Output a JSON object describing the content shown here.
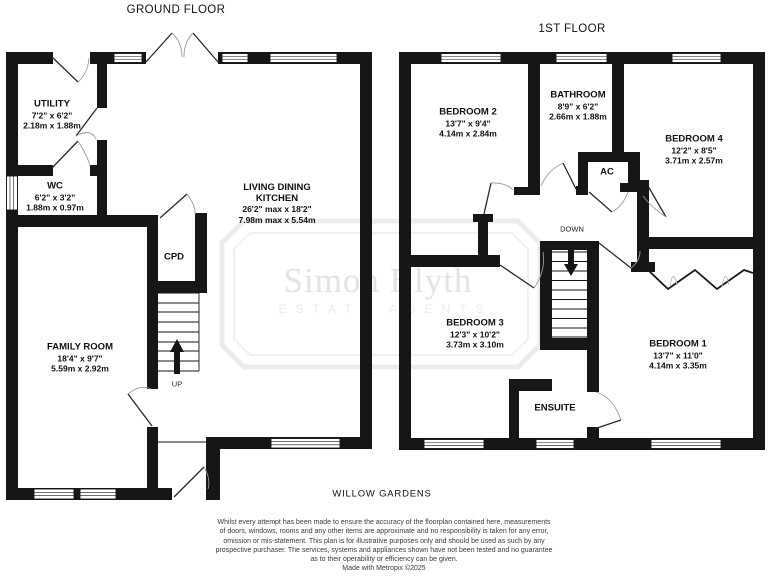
{
  "ground_floor": {
    "title": "GROUND FLOOR",
    "rooms": [
      {
        "name": "UTILITY",
        "imperial": "7'2\" x 6'2\"",
        "metric": "2.18m x 1.88m"
      },
      {
        "name": "WC",
        "imperial": "6'2\" x 3'2\"",
        "metric": "1.88m x 0.97m"
      },
      {
        "name": "LIVING DINING KITCHEN",
        "name_line1": "LIVING DINING",
        "name_line2": "KITCHEN",
        "imperial": "26'2\" max x 18'2\"",
        "metric": "7.98m max x 5.54m"
      },
      {
        "name": "FAMILY ROOM",
        "imperial": "18'4\" x 9'7\"",
        "metric": "5.59m x 2.92m"
      }
    ],
    "cupboard_label": "CPD",
    "stairs_label": "UP"
  },
  "first_floor": {
    "title": "1ST FLOOR",
    "rooms": [
      {
        "name": "BEDROOM 2",
        "imperial": "13'7\" x 9'4\"",
        "metric": "4.14m x 2.84m"
      },
      {
        "name": "BATHROOM",
        "imperial": "8'9\" x 6'2\"",
        "metric": "2.66m x 1.88m"
      },
      {
        "name": "BEDROOM 4",
        "imperial": "12'2\" x 8'5\"",
        "metric": "3.71m x 2.57m"
      },
      {
        "name": "BEDROOM 3",
        "imperial": "12'3\" x 10'2\"",
        "metric": "3.73m x 3.10m"
      },
      {
        "name": "BEDROOM 1",
        "imperial": "13'7\" x 11'0\"",
        "metric": "4.14m x 3.35m"
      }
    ],
    "airing_cupboard_label": "AC",
    "stairs_label": "DOWN",
    "ensuite_label": "ENSUITE"
  },
  "address": "WILLOW GARDENS",
  "watermark": {
    "name": "Simon Blyth",
    "subtitle": "ESTATE AGENTS"
  },
  "disclaimer": {
    "lines": [
      "Whilst every attempt has been made to ensure the accuracy of the floorplan contained here, measurements",
      "of doors, windows, rooms and any other items are approximate and no responsibility is taken for any error,",
      "omission or mis-statement. This plan is for illustrative purposes only and should be used as such by any",
      "prospective purchaser. The services, systems and appliances shown have not been tested and no guarantee",
      "as to their operability or efficiency can be given.",
      "Made with Metropix ©2025"
    ]
  },
  "colors": {
    "wall": "#161616",
    "door_arc": "#9a9a9a",
    "watermark": "#ececec",
    "text": "#111111"
  }
}
